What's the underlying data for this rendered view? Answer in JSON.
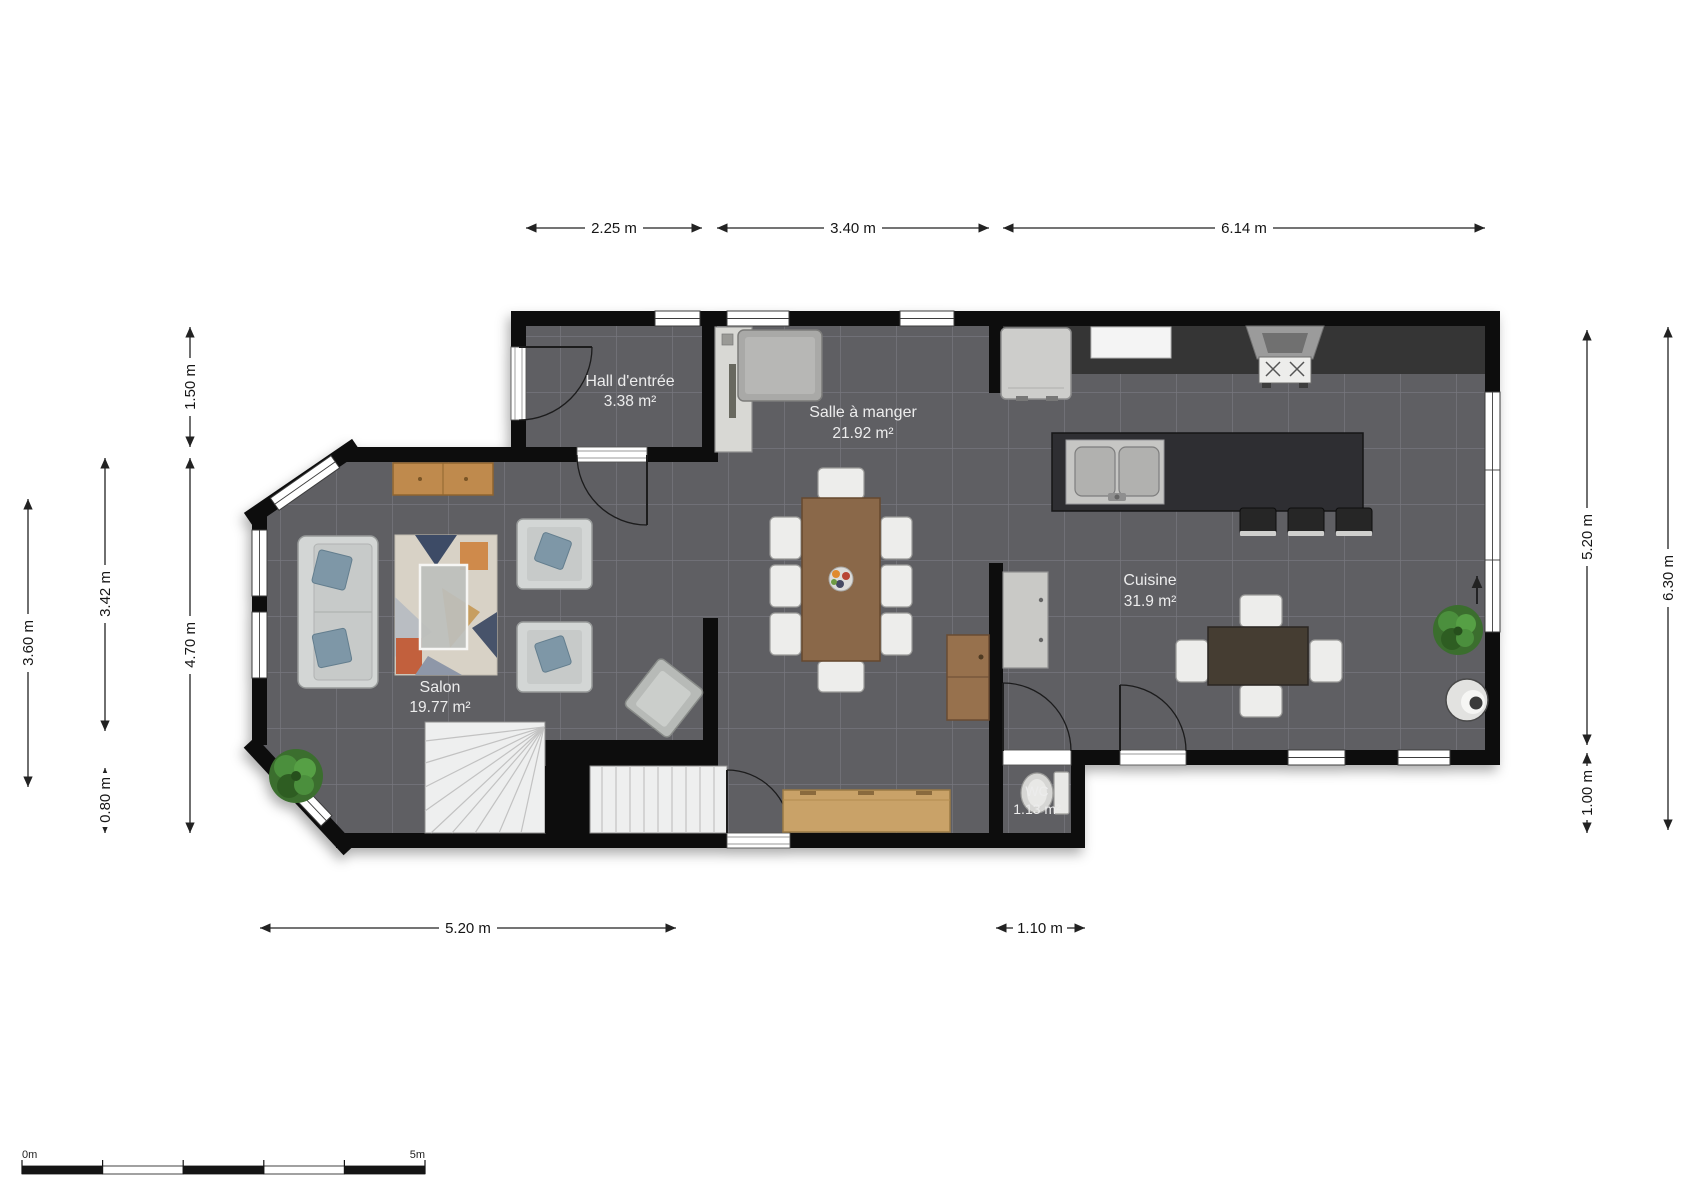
{
  "floorplan": {
    "rooms": {
      "hall": {
        "name": "Hall d'entrée",
        "area": "3.38 m²"
      },
      "dining": {
        "name": "Salle à manger",
        "area": "21.92 m²"
      },
      "kitchen": {
        "name": "Cuisine",
        "area": "31.9 m²"
      },
      "salon": {
        "name": "Salon",
        "area": "19.77 m²"
      },
      "wc": {
        "name": "WC",
        "area": "1.13 m²"
      }
    },
    "dimensions": {
      "top": [
        {
          "label": "2.25 m"
        },
        {
          "label": "3.40 m"
        },
        {
          "label": "6.14 m"
        }
      ],
      "left": [
        {
          "label": "1.50 m"
        },
        {
          "label": "3.60 m"
        },
        {
          "label": "3.42 m"
        },
        {
          "label": "4.70 m"
        },
        {
          "label": "0.80 m"
        }
      ],
      "right": [
        {
          "label": "5.20 m"
        },
        {
          "label": "6.30 m"
        },
        {
          "label": "1.00 m"
        }
      ],
      "bottom": [
        {
          "label": "5.20 m"
        },
        {
          "label": "1.10 m"
        }
      ]
    },
    "scale_bar": {
      "start": "0m",
      "end": "5m"
    },
    "colors": {
      "wall": "#0b0b0b",
      "floor_tile": "#5e5e64",
      "tile_grout": "#8b8b91",
      "kitchen_counter": "#343434",
      "kitchen_island": "#2e2e30",
      "wood_bench": "#c9a267",
      "wood_sideboard": "#bf8a4d",
      "wood_dining_table": "#8a6848",
      "wood_kitchen_table": "#453e32",
      "pillow_accent": "#7e97a7",
      "plant_green": "#4c8f3c",
      "label_text": "#ececec",
      "dimension_text": "#161616"
    }
  }
}
